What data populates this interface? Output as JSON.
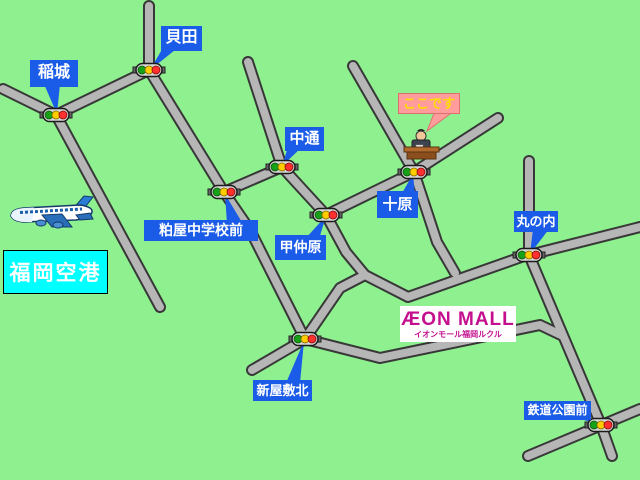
{
  "labels": {
    "inaki": "稲城",
    "kaida": "貝田",
    "nakadori": "中通",
    "kasuya_jhs": "粕屋中学校前",
    "konakabaru": "甲仲原",
    "tobaru": "十原",
    "marunouchi": "丸の内",
    "shinyashiki_kita": "新屋敷北",
    "tetsudo_koen_mae": "鉄道公園前"
  },
  "here": {
    "text": "ここです"
  },
  "airport": {
    "name": "福岡空港"
  },
  "mall": {
    "logo": "ÆON MALL",
    "subtitle": "イオンモール福岡ルクル"
  },
  "colors": {
    "background": "#8ef08e",
    "road_fill": "#b6b6b6",
    "road_casing": "#383838",
    "label_blue": "#1a5ce8",
    "here_pink": "#ff9c9c",
    "here_text": "#ffdf00",
    "airport_cyan": "#00ffff",
    "aeon_magenta": "#c40f8e",
    "signal_green": "#18a018",
    "signal_yellow": "#ffcc00",
    "signal_red": "#ff3030"
  }
}
